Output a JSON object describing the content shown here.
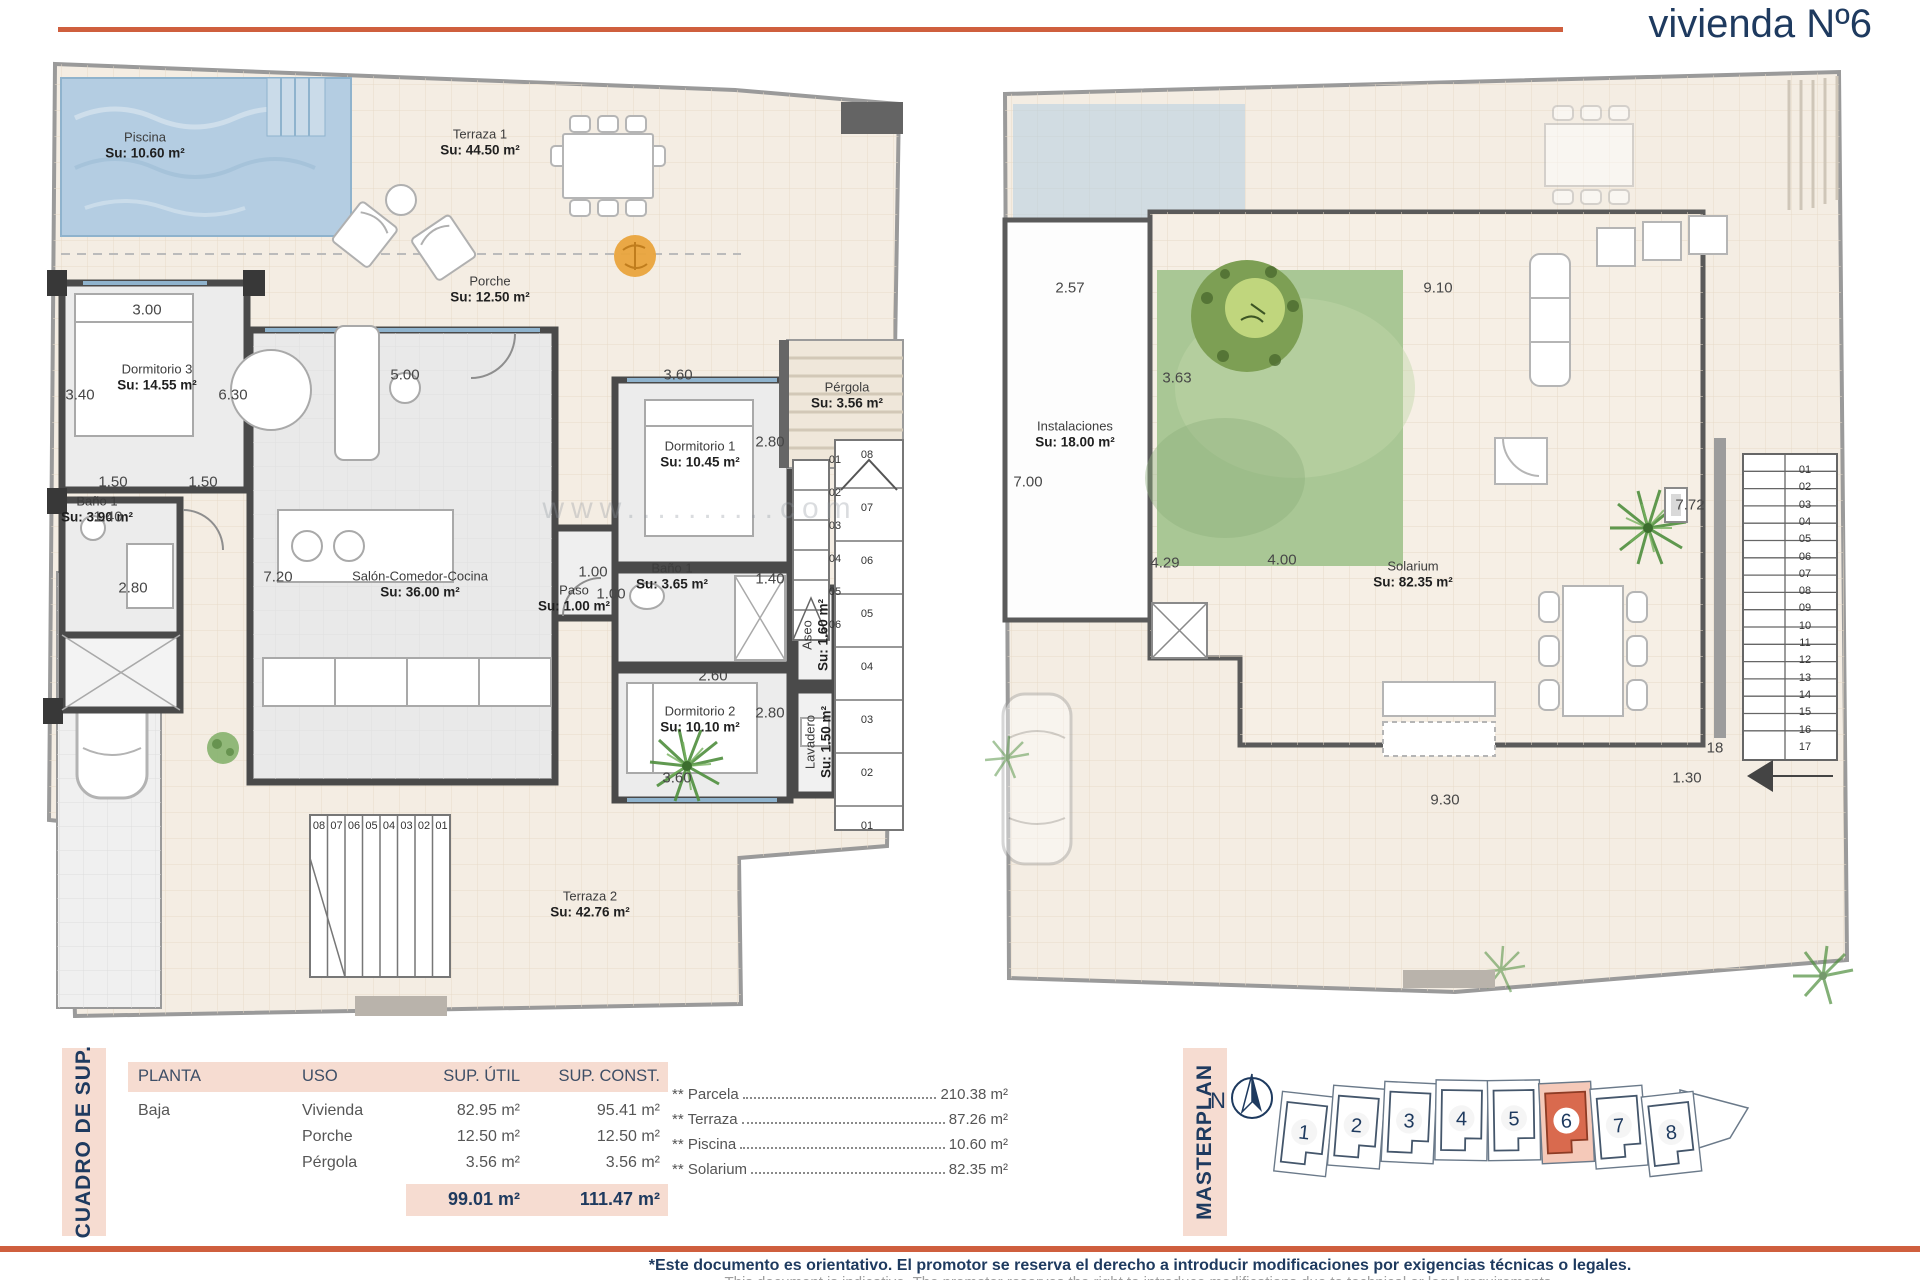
{
  "title": "vivienda Nº6",
  "watermark": "www..........com",
  "left_plan": {
    "labels": [
      {
        "name": "Piscina",
        "area": "Su: 10.60 m²",
        "x": 110,
        "y": 88
      },
      {
        "name": "Terraza 1",
        "area": "Su: 44.50 m²",
        "x": 445,
        "y": 85
      },
      {
        "name": "Porche",
        "area": "Su: 12.50 m²",
        "x": 455,
        "y": 232
      },
      {
        "name": "Dormitorio 3",
        "area": "Su: 14.55 m²",
        "x": 122,
        "y": 320
      },
      {
        "name": "Baño 1",
        "area": "Su: 3.90 m²",
        "x": 62,
        "y": 452
      },
      {
        "name": "Salón-Comedor-Cocina",
        "area": "Su: 36.00 m²",
        "x": 385,
        "y": 527
      },
      {
        "name": "Paso",
        "area": "Su: 1.00 m²",
        "x": 539,
        "y": 541
      },
      {
        "name": "Dormitorio 1",
        "area": "Su: 10.45 m²",
        "x": 665,
        "y": 397
      },
      {
        "name": "Baño 1",
        "area": "Su: 3.65 m²",
        "x": 637,
        "y": 519
      },
      {
        "name": "Dormitorio 2",
        "area": "Su: 10.10 m²",
        "x": 665,
        "y": 662
      },
      {
        "name": "Pérgola",
        "area": "Su: 3.56 m²",
        "x": 812,
        "y": 338
      },
      {
        "name": "Aseo",
        "area": "Su: 1.60 m²",
        "x": 781,
        "y": 577,
        "rot": true
      },
      {
        "name": "Lavadero",
        "area": "Su: 1.50 m²",
        "x": 784,
        "y": 684,
        "rot": true
      },
      {
        "name": "Terraza 2",
        "area": "Su: 42.76 m²",
        "x": 555,
        "y": 847
      }
    ],
    "dims": [
      {
        "t": "3.00",
        "x": 112,
        "y": 252
      },
      {
        "t": "3.40",
        "x": 45,
        "y": 337
      },
      {
        "t": "6.30",
        "x": 198,
        "y": 337
      },
      {
        "t": "1.50",
        "x": 78,
        "y": 424
      },
      {
        "t": "1.50",
        "x": 168,
        "y": 424
      },
      {
        "t": "1.40",
        "x": 73,
        "y": 459
      },
      {
        "t": "5.00",
        "x": 370,
        "y": 317
      },
      {
        "t": "7.20",
        "x": 243,
        "y": 519
      },
      {
        "t": "2.80",
        "x": 98,
        "y": 530
      },
      {
        "t": "1.00",
        "x": 558,
        "y": 514
      },
      {
        "t": "1.00",
        "x": 576,
        "y": 536
      },
      {
        "t": "3.60",
        "x": 643,
        "y": 317
      },
      {
        "t": "2.80",
        "x": 735,
        "y": 384
      },
      {
        "t": "1.40",
        "x": 735,
        "y": 521
      },
      {
        "t": "2.60",
        "x": 678,
        "y": 618
      },
      {
        "t": "2.80",
        "x": 735,
        "y": 655
      },
      {
        "t": "3.60",
        "x": 642,
        "y": 720
      }
    ],
    "stairs": [
      {
        "x": 800,
        "y": 402,
        "dx": 0,
        "dy": 33,
        "values": [
          "01",
          "02",
          "03",
          "04",
          "05",
          "06"
        ]
      },
      {
        "x": 832,
        "y": 397,
        "dx": 0,
        "dy": 53,
        "values": [
          "08",
          "07",
          "06",
          "05",
          "04",
          "03",
          "02",
          "01"
        ]
      },
      {
        "x": 284,
        "y": 768,
        "dx": 17.5,
        "dy": 0,
        "values": [
          "08",
          "07",
          "06",
          "05",
          "04",
          "03",
          "02",
          "01"
        ]
      }
    ]
  },
  "right_plan": {
    "labels": [
      {
        "name": "Instalaciones",
        "area": "Su: 18.00 m²",
        "x": 90,
        "y": 377
      },
      {
        "name": "Solarium",
        "area": "Su: 82.35 m²",
        "x": 428,
        "y": 517
      }
    ],
    "dims": [
      {
        "t": "2.57",
        "x": 85,
        "y": 230
      },
      {
        "t": "9.10",
        "x": 453,
        "y": 230
      },
      {
        "t": "3.63",
        "x": 192,
        "y": 320
      },
      {
        "t": "4.00",
        "x": 297,
        "y": 502
      },
      {
        "t": "7.00",
        "x": 43,
        "y": 424
      },
      {
        "t": "7.72",
        "x": 705,
        "y": 447
      },
      {
        "t": "4.29",
        "x": 180,
        "y": 505
      },
      {
        "t": "9.30",
        "x": 460,
        "y": 742
      },
      {
        "t": "1.30",
        "x": 702,
        "y": 720
      },
      {
        "t": "18",
        "x": 730,
        "y": 690
      }
    ],
    "stairs": [
      {
        "x": 820,
        "y": 412,
        "dx": 0,
        "dy": 17.3,
        "values": [
          "01",
          "02",
          "03",
          "04",
          "05",
          "06",
          "07",
          "08",
          "09",
          "10",
          "11",
          "12",
          "13",
          "14",
          "15",
          "16",
          "17"
        ]
      }
    ]
  },
  "table": {
    "band_label": "CUADRO DE SUP.",
    "headers": [
      "PLANTA",
      "USO",
      "SUP. ÚTIL",
      "SUP. CONST."
    ],
    "rows": [
      {
        "planta": "Baja",
        "uso": "Vivienda",
        "util": "82.95 m²",
        "const": "95.41 m²"
      },
      {
        "planta": "",
        "uso": "Porche",
        "util": "12.50 m²",
        "const": "12.50 m²"
      },
      {
        "planta": "",
        "uso": "Pérgola",
        "util": "3.56 m²",
        "const": "3.56 m²"
      }
    ],
    "total_util": "99.01 m²",
    "total_const": "111.47 m²"
  },
  "summary": [
    {
      "label": "** Parcela",
      "value": "210.38 m²"
    },
    {
      "label": "** Terraza",
      "value": "87.26 m²"
    },
    {
      "label": "** Piscina",
      "value": "10.60 m²"
    },
    {
      "label": "** Solarium",
      "value": "82.35 m²"
    }
  ],
  "masterplan": {
    "band_label": "MASTERPLAN",
    "north": "N",
    "units": [
      "1",
      "2",
      "3",
      "4",
      "5",
      "6",
      "7",
      "8"
    ],
    "highlighted": "6",
    "highlight_color": "#d96a4e",
    "highlight_plot_color": "#f5c9b9"
  },
  "footer": {
    "line1": "*Este documento es orientativo. El promotor se reserva el derecho a introducir modificaciones por exigencias técnicas o legales.",
    "line2": "This document is indicative. The promoter reserves the right to introduce modifications due to technical or legal requirements."
  },
  "accent_color": "#cf5f3e",
  "navy_color": "#1e3a5f"
}
